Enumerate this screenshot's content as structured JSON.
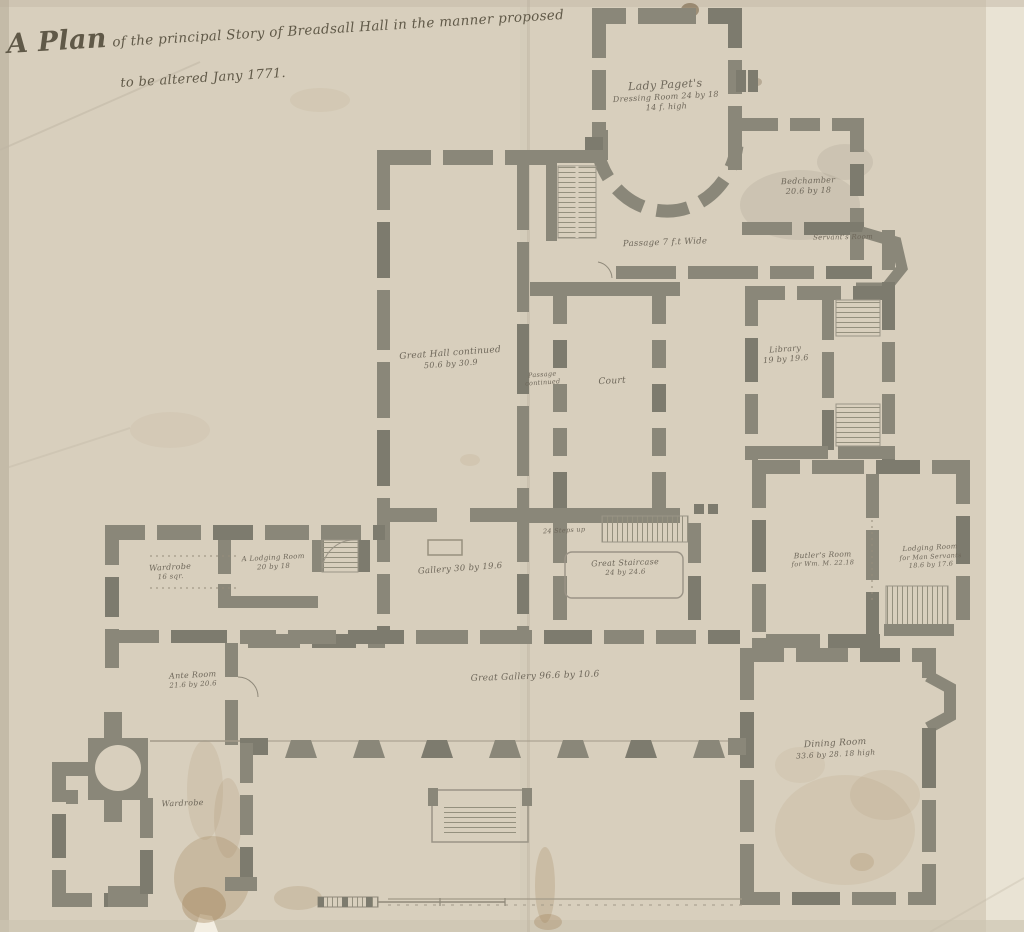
{
  "title": {
    "big": "A Plan",
    "rest": "of the principal Story of Breadsall Hall in the manner proposed",
    "line2": "to be altered Jany 1771."
  },
  "rooms": {
    "lady_pagets": {
      "l1": "Lady Paget's",
      "l2": "Dressing Room 24 by 18",
      "l3": "14 f. high"
    },
    "bedchamber": {
      "l1": "Bedchamber",
      "l2": "20.6 by 18"
    },
    "servants_room": {
      "l1": "Servant's Room"
    },
    "passage": {
      "l1": "Passage 7 f.t Wide"
    },
    "great_hall": {
      "l1": "Great Hall continued",
      "l2": "50.6 by 30.9"
    },
    "passage_continued": {
      "l1": "Passage",
      "l2": "continued"
    },
    "court": {
      "l1": "Court"
    },
    "library": {
      "l1": "Library",
      "l2": "19 by 19.6"
    },
    "gallery": {
      "l1": "Gallery 30 by 19.6"
    },
    "stair_note": {
      "l1": "24 Steps up"
    },
    "great_staircase": {
      "l1": "Great Staircase",
      "l2": "24 by 24.6"
    },
    "wardrobe_upper": {
      "l1": "Wardrobe",
      "l2": "16 sqr."
    },
    "lodging_room_left": {
      "l1": "A Lodging Room",
      "l2": "20 by 18"
    },
    "ante_room": {
      "l1": "Ante Room",
      "l2": "21.6 by 20.6"
    },
    "great_gallery": {
      "l1": "Great Gallery 96.6 by 10.6"
    },
    "butlers_room": {
      "l1": "Butler's Room",
      "l2": "for Wm. M. 22.18"
    },
    "lodging_room_right": {
      "l1": "Lodging Room",
      "l2": "for Man Servants",
      "l3": "18.6 by 17.6"
    },
    "dining_room": {
      "l1": "Dining Room",
      "l2": "33.6 by 28. 18 high"
    },
    "wardrobe_lower": {
      "l1": "Wardrobe"
    }
  },
  "colors": {
    "paper": "#d8cfbd",
    "wall": "#8a8779",
    "ink": "#6e675a"
  }
}
